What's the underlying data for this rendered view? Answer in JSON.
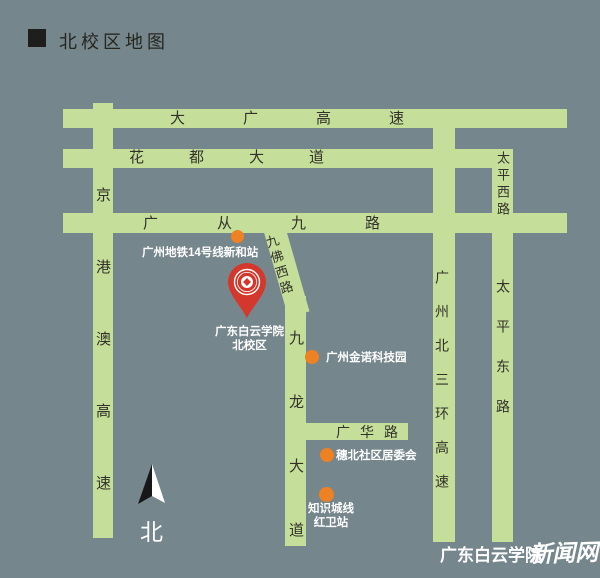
{
  "title": "北校区地图",
  "colors": {
    "background": "#75868C",
    "road": "#C5DF9A",
    "marker_orange": "#EE8122",
    "pin_red": "#D4372C",
    "road_text": "#32322A",
    "label_text": "#FFFFFF"
  },
  "roads": {
    "daguang_expressway": "大广高速",
    "huadu_avenue": "花都大道",
    "guangcong_jiu_road": "广从九路",
    "jinggangao_expressway": "京港澳高速",
    "jiufo_west_road": "九佛西路",
    "jiulong_avenue": "九龙大道",
    "guanghua_road": "广华路",
    "gz_north_third_ring_expressway": "广州北三环高速",
    "taiping_west_road": "太平西路",
    "taiping_east_road": "太平东路"
  },
  "markers": {
    "metro_station": "广州地铁14号线新和站",
    "campus_name": "广东白云学院",
    "campus_sub": "北校区",
    "jinnuo_tech_park": "广州金诺科技园",
    "suibei_committee": "穗北社区居委会",
    "knowledge_city_line": "知识城线",
    "hongwei_station": "红卫站"
  },
  "compass": "北",
  "watermark": {
    "org": "广东白云学院",
    "site": "新闻网"
  }
}
